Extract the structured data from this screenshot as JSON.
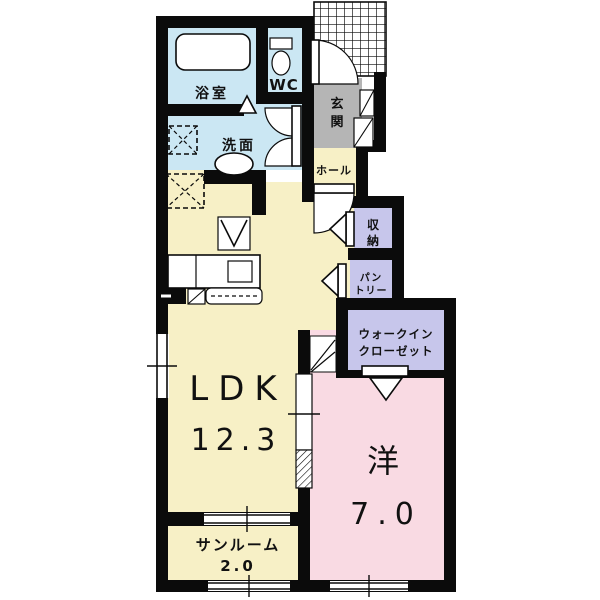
{
  "plan": {
    "type": "floor-plan",
    "rooms": {
      "bathroom": {
        "label": "浴室"
      },
      "wc": {
        "label": "WC"
      },
      "washroom": {
        "label": "洗面"
      },
      "entrance": {
        "label": "玄関",
        "char1": "玄",
        "char2": "関"
      },
      "hall": {
        "label": "ホール"
      },
      "storage": {
        "label": "収納",
        "char1": "収",
        "char2": "納"
      },
      "pantry": {
        "label": "パントリー",
        "line1": "パン",
        "line2": "トリー"
      },
      "walk_in_closet": {
        "label": "ウォークインクローゼット",
        "line1": "ウォークイン",
        "line2": "クローゼット"
      },
      "ldk": {
        "label": "LDK",
        "size": "12.3"
      },
      "western_room": {
        "label": "洋",
        "size": "7.0"
      },
      "sunroom": {
        "label": "サンルーム",
        "size": "2.0"
      }
    },
    "colors": {
      "room_cream": "#f7f0c6",
      "room_pink": "#f9dae3",
      "room_lavender": "#c7c6eb",
      "room_blue": "#cbe7f3",
      "room_gray": "#b5b5b5",
      "wall": "#0b0b0b",
      "fixture": "#ffffff"
    }
  }
}
